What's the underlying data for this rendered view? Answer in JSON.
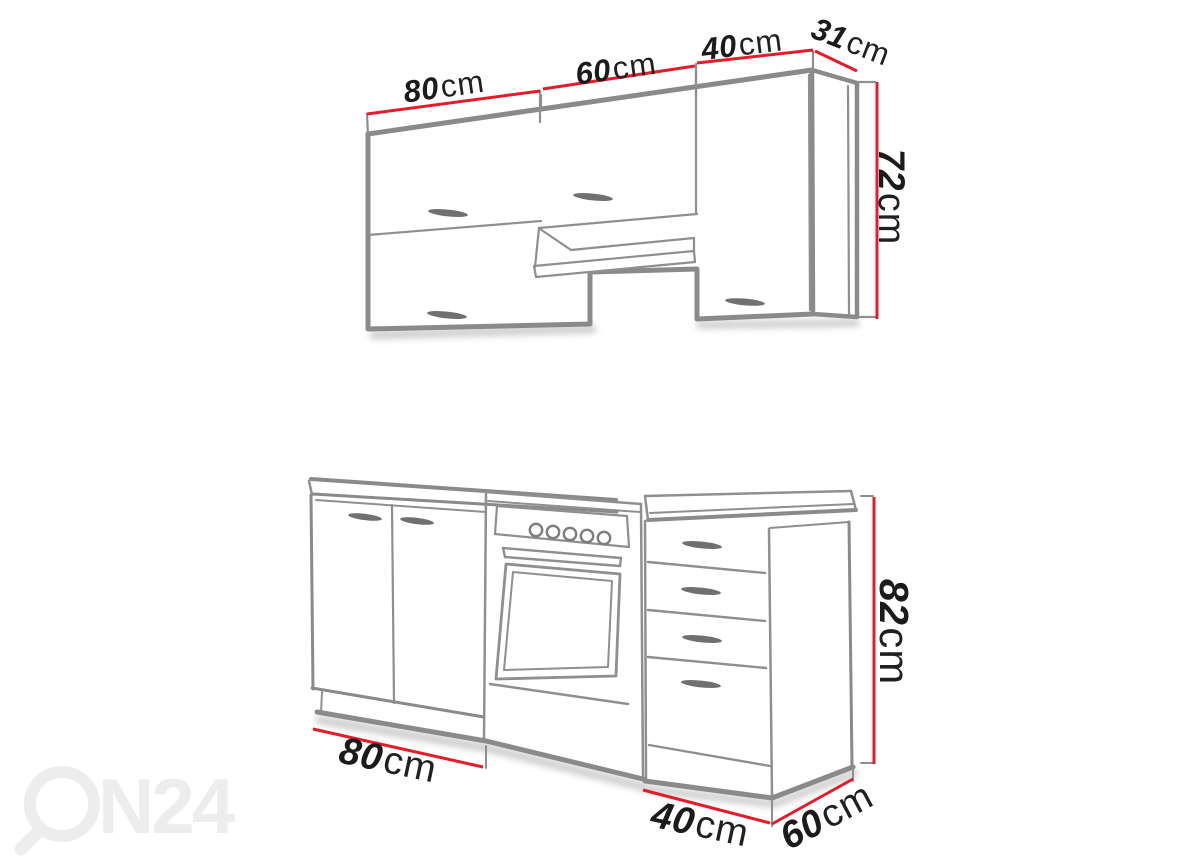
{
  "description": "Kitchen cabinet set dimension diagram (line-art product drawing)",
  "watermark": {
    "brand_text": "N24",
    "icon": "magnifier-ring-as-letter-O"
  },
  "upper_unit": {
    "name": "wall cabinets",
    "dim_80": {
      "value": "80",
      "unit": "cm"
    },
    "dim_60": {
      "value": "60",
      "unit": "cm"
    },
    "dim_40": {
      "value": "40",
      "unit": "cm"
    },
    "dim_31": {
      "value": "31",
      "unit": "cm"
    },
    "dim_72": {
      "value": "72",
      "unit": "cm"
    }
  },
  "lower_unit": {
    "name": "base cabinets with cooker and drawer unit",
    "dim_82": {
      "value": "82",
      "unit": "cm"
    },
    "dim_80": {
      "value": "80",
      "unit": "cm"
    },
    "dim_40": {
      "value": "40",
      "unit": "cm"
    },
    "dim_60": {
      "value": "60",
      "unit": "cm"
    }
  },
  "colors": {
    "dimension_line_red": "#e31c2a",
    "drawing_gray": "#8a8a8a",
    "thin_line_gray": "#8f8f8f",
    "handle_gray": "#707070",
    "label_text": "#1b1b1b",
    "watermark_gray": "#ededed"
  }
}
